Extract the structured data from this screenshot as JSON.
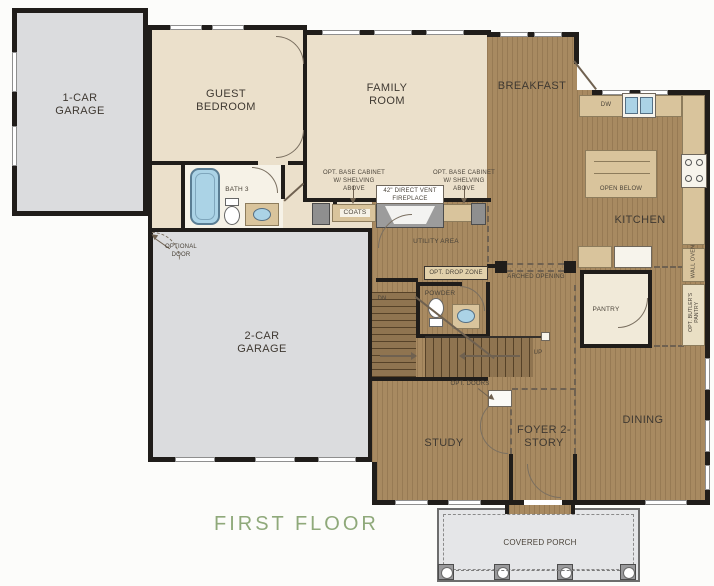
{
  "title": "FIRST FLOOR",
  "rooms": {
    "garage_1": "1-CAR GARAGE",
    "guest_bedroom": "GUEST BEDROOM",
    "bath_3": "BATH 3",
    "coats": "COATS",
    "family_room": "FAMILY ROOM",
    "breakfast": "BREAKFAST",
    "kitchen": "KITCHEN",
    "open_below": "OPEN BELOW",
    "garage_2": "2-CAR GARAGE",
    "utility": "UTILITY AREA",
    "powder": "POWDER",
    "pantry": "PANTRY",
    "study": "STUDY",
    "foyer": "FOYER 2-STORY",
    "dining": "DINING",
    "covered_porch": "COVERED PORCH"
  },
  "annotations": {
    "optional_door": "OPTIONAL DOOR",
    "opt_base_cabinet_left": "OPT. BASE CABINET W/ SHELVING ABOVE",
    "opt_base_cabinet_right": "OPT. BASE CABINET W/ SHELVING ABOVE",
    "fireplace": "42\" DIRECT VENT FIREPLACE",
    "opt_drop_zone": "OPT. DROP ZONE",
    "arched_opening": "ARCHED OPENING",
    "opt_doors": "OPT. DOORS",
    "dn": "DN",
    "up": "UP",
    "dw": "DW",
    "wall_oven": "WALL OVEN",
    "opt_butlers_pantry": "OPT. BUTLER'S PANTRY"
  },
  "colors": {
    "wall": "#201d1a",
    "beige_floor": "#ebe0cb",
    "wood_floor": "#a88a61",
    "garage_floor": "#dbdcde",
    "porch_floor": "#e5e6e8",
    "counter_tan": "#d9c49c",
    "pantry_cream": "#f1ead9",
    "fixture_blue": "#abd3e6",
    "title_green": "#8fa97a"
  }
}
